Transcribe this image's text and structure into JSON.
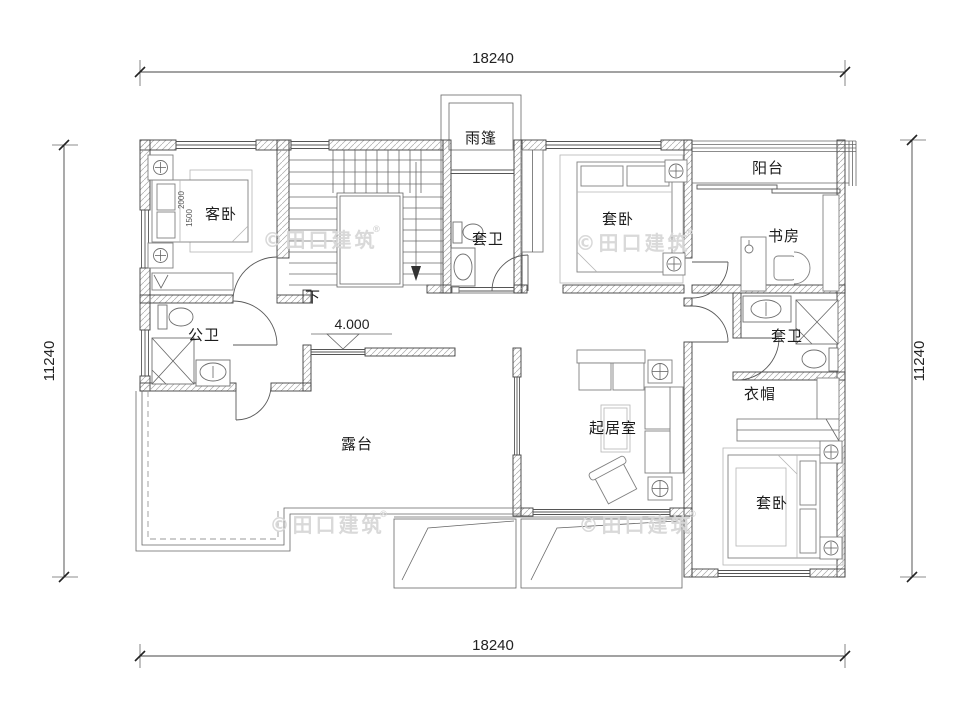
{
  "dims": {
    "top": "18240",
    "bottom": "18240",
    "left": "11240",
    "right": "11240"
  },
  "rooms": {
    "canopy": "雨篷",
    "guest_bedroom": "客卧",
    "entry_bath": "套卫",
    "suite_bedroom_top": "套卧",
    "balcony": "阳台",
    "study": "书房",
    "public_bath": "公卫",
    "suite_bath": "套卫",
    "cloakroom": "衣帽",
    "living_room": "起居室",
    "terrace": "露台",
    "suite_bedroom_bottom": "套卧",
    "stair_down": "下"
  },
  "annotations": {
    "elevation": "4.000",
    "bed_length": "2000",
    "bed_width": "1500"
  },
  "watermark": {
    "text": "©田口建筑",
    "reg": "®"
  },
  "colors": {
    "background": "#ffffff",
    "wall_edge": "#3f3f3f",
    "hatch": "#a8a8a8",
    "line": "#555555",
    "watermark": "#d7d7d7"
  }
}
